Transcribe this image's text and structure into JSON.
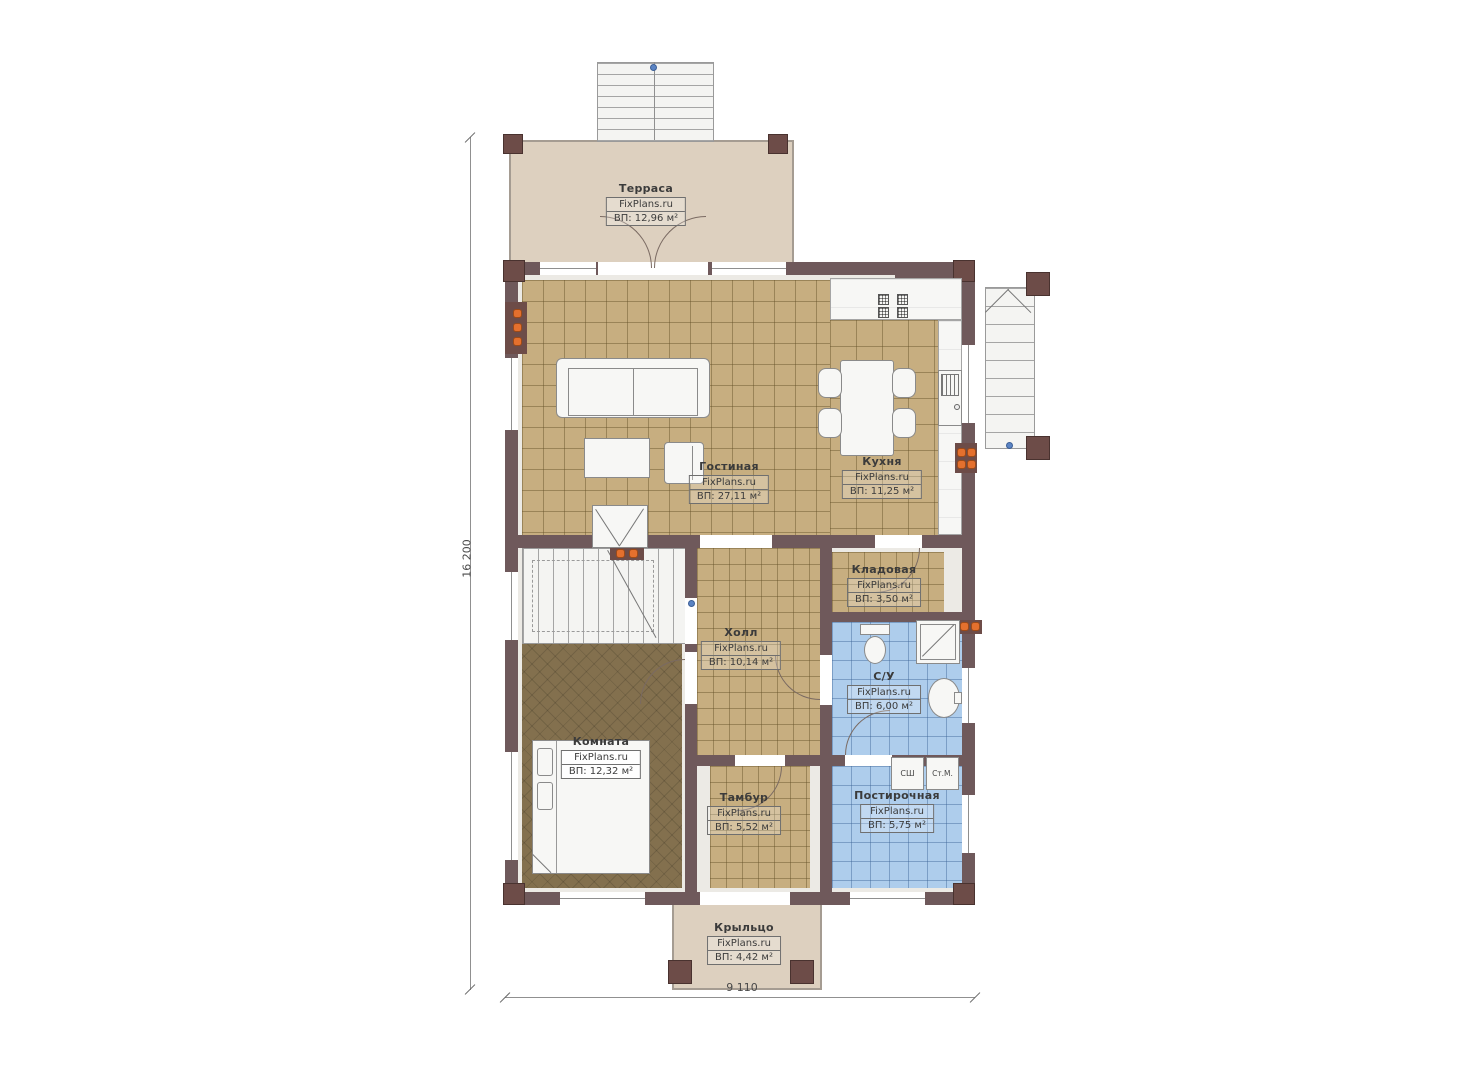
{
  "watermark": "FixPlans.ru",
  "dimensions": {
    "height_mm": "16 200",
    "width_mm": "9 110"
  },
  "rooms": [
    {
      "id": "terrace",
      "name": "Терраса",
      "watermark": "FixPlans.ru",
      "area": "ВП: 12,96 м²"
    },
    {
      "id": "living",
      "name": "Гостиная",
      "watermark": "FixPlans.ru",
      "area": "ВП: 27,11 м²"
    },
    {
      "id": "kitchen",
      "name": "Кухня",
      "watermark": "FixPlans.ru",
      "area": "ВП: 11,25 м²"
    },
    {
      "id": "storage",
      "name": "Кладовая",
      "watermark": "FixPlans.ru",
      "area": "ВП: 3,50 м²"
    },
    {
      "id": "hall",
      "name": "Холл",
      "watermark": "FixPlans.ru",
      "area": "ВП: 10,14 м²"
    },
    {
      "id": "bathroom",
      "name": "С/У",
      "watermark": "FixPlans.ru",
      "area": "ВП: 6,00 м²"
    },
    {
      "id": "bedroom",
      "name": "Комната",
      "watermark": "FixPlans.ru",
      "area": "ВП: 12,32 м²"
    },
    {
      "id": "tambur",
      "name": "Тамбур",
      "watermark": "FixPlans.ru",
      "area": "ВП: 5,52 м²"
    },
    {
      "id": "laundry",
      "name": "Постирочная",
      "watermark": "FixPlans.ru",
      "area": "ВП: 5,75 м²"
    },
    {
      "id": "porch",
      "name": "Крыльцо",
      "watermark": "FixPlans.ru",
      "area": "ВП: 4,42 м²"
    }
  ],
  "appliances": {
    "dryer": "СШ",
    "washer": "Ст.М."
  },
  "colors": {
    "wall": "#6f595b",
    "post": "#6d4c48",
    "floor_tile_tan": "#c7ae80",
    "floor_tile_blue": "#aecdec",
    "floor_carpet": "#83704e",
    "deck": "#ddd0bf",
    "radiator": "#e4702e",
    "marker": "#5b84c4"
  }
}
